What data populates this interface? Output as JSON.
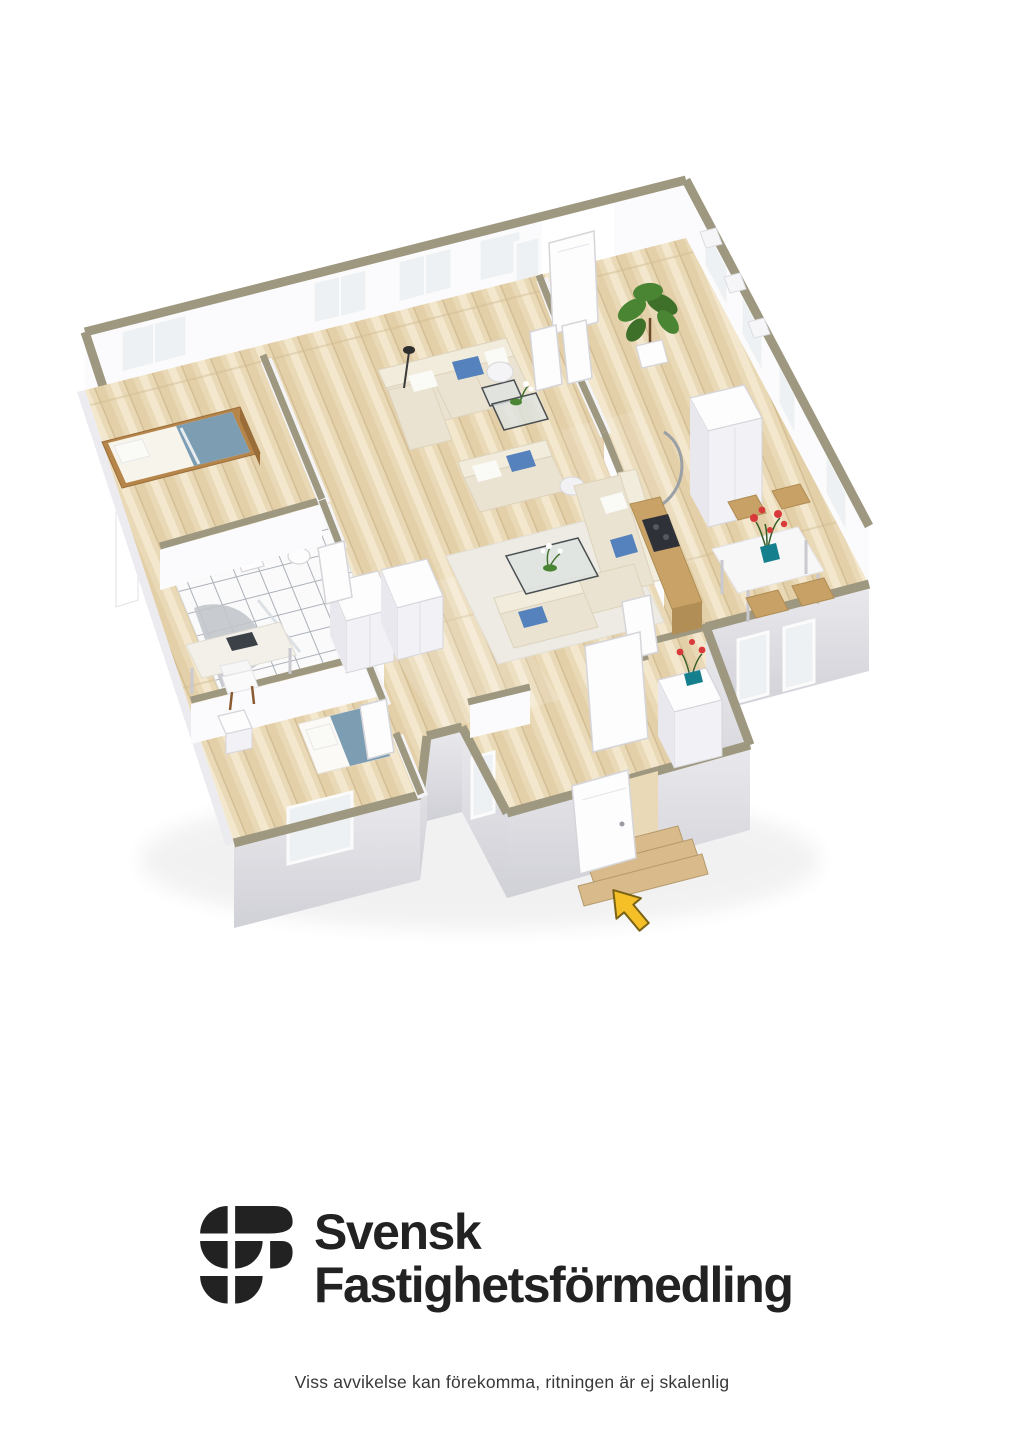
{
  "page": {
    "background": "#ffffff"
  },
  "branding": {
    "logo_symbol": "sf-monogram",
    "line1": "Svensk",
    "line2": "Fastighetsförmedling"
  },
  "disclaimer": "Viss avvikelse kan förekomma, ritningen är ej skalenlig",
  "floorplan": {
    "view": "3d-isometric-dollhouse-render",
    "rooms": [
      {
        "id": "bedroom",
        "label": "bedroom with single bed"
      },
      {
        "id": "bathroom",
        "label": "tiled bathroom with shower, toilet and basin"
      },
      {
        "id": "living-room",
        "label": "living room with two seating groups, coffee table and lamps"
      },
      {
        "id": "hallway",
        "label": "upper hallway with potted plant and balcony door"
      },
      {
        "id": "kitchen",
        "label": "kitchen nook with cooktop, counter and fridge"
      },
      {
        "id": "dining-area",
        "label": "dining area with white table, four chairs and red flowers"
      },
      {
        "id": "office",
        "label": "office bedroom with desk, chair and single bed"
      },
      {
        "id": "entrance",
        "label": "entrance hall with sideboard, open front door and wooden steps"
      }
    ],
    "entrance_arrow": {
      "shape": "arrow",
      "points_to": "front door"
    }
  },
  "colors": {
    "pageBg": "#ffffff",
    "wood": "#ead9b6",
    "woodDark": "#dcc69c",
    "woodLight": "#f5ecd4",
    "plankLine": "#d2bc92",
    "wallTop": "#9e9880",
    "wallFace": "#fbfbfd",
    "wallShade": "#ececf1",
    "extLight": "#e9e9ed",
    "extDark": "#d0d0d7",
    "glass": "#edf1f4",
    "frameWhite": "#fbfbfb",
    "tileFill": "#fafafa",
    "tileGrout": "#aab0b8",
    "sofaBase": "#ebe3d1",
    "sofaBack": "#f2ecdd",
    "sofaLine": "#ddd3bc",
    "pillowBlue": "#5581bd",
    "pillowWhite": "#fafaf7",
    "bedBlue": "#7d9db3",
    "woodFurn": "#b5854a",
    "woodFurnDark": "#9a6d38",
    "counterWood": "#c8a266",
    "cooktopDark": "#2e3138",
    "chairTan": "#c8a166",
    "tableWhite": "#f7f7f8",
    "flowerRed": "#d8393b",
    "vaseTeal": "#157f8d",
    "plantGreen": "#4a8534",
    "plantDark": "#3e7029",
    "rug": "#edebe4",
    "glassTable": "#dde3e1",
    "arrowYellow": "#f4bf27",
    "arrowOutline": "#7a6317",
    "stepWood": "#d9ba8a",
    "stepLine": "#b59a6d",
    "doorWhite": "#fdfdfe",
    "doorEdge": "#d5d5da",
    "logoInk": "#222222",
    "disclaimerInk": "#383838"
  }
}
